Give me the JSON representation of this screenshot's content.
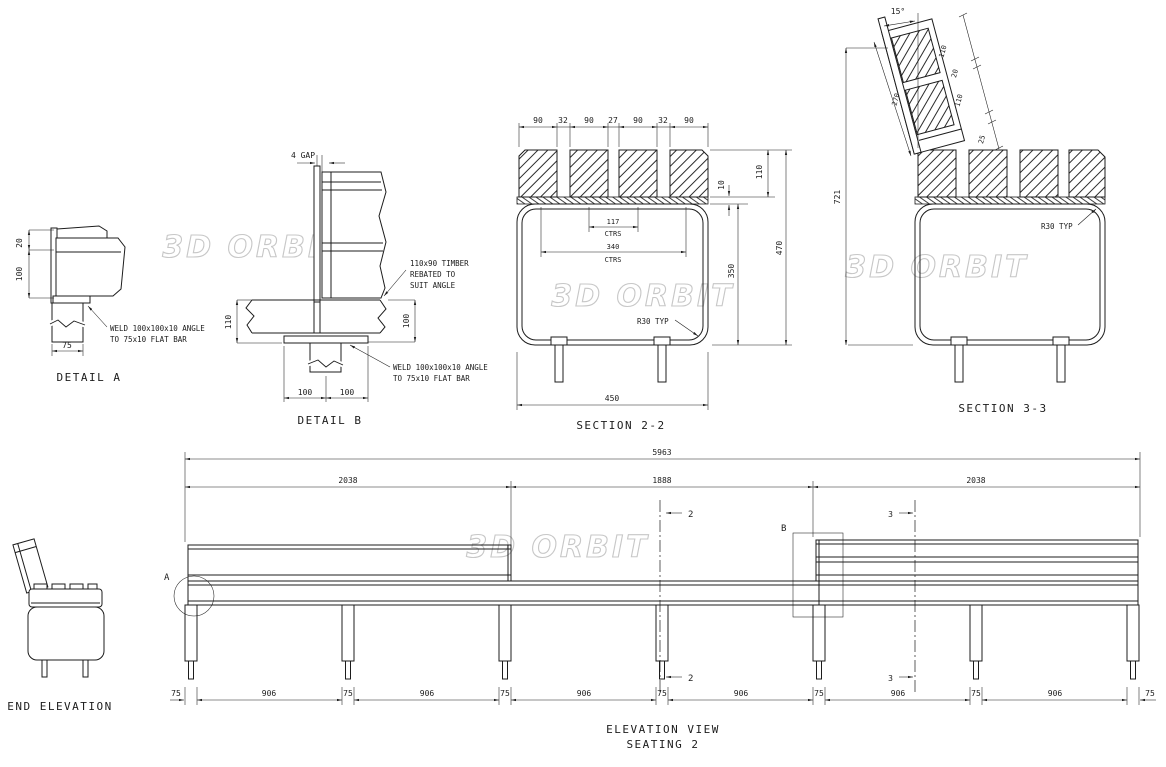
{
  "watermark": "3D ORBIT",
  "colors": {
    "line": "#1c1c1c",
    "watermark": "#c7c7c7",
    "background": "#ffffff"
  },
  "detail_a": {
    "title": "DETAIL A",
    "dim_20": "20",
    "dim_100": "100",
    "dim_75": "75",
    "note_weld_line1": "WELD 100x100x10 ANGLE",
    "note_weld_line2": "TO 75x10 FLAT BAR"
  },
  "detail_b": {
    "title": "DETAIL B",
    "dim_gap": "4 GAP",
    "note_timber_line1": "110x90 TIMBER",
    "note_timber_line2": "REBATED TO",
    "note_timber_line3": "SUIT ANGLE",
    "note_weld_line1": "WELD 100x100x10 ANGLE",
    "note_weld_line2": "TO 75x10 FLAT BAR",
    "dim_110": "110",
    "dim_100_right": "100",
    "dim_100_bottom_left": "100",
    "dim_100_bottom_right": "100"
  },
  "section_2_2": {
    "title": "SECTION 2-2",
    "top_dims": [
      "90",
      "32",
      "90",
      "27",
      "90",
      "32",
      "90"
    ],
    "dim_117": "117",
    "dim_340": "340",
    "ctrs_label": "CTRS",
    "dim_10": "10",
    "dim_110": "110",
    "dim_350": "350",
    "dim_470": "470",
    "dim_450": "450",
    "r30_note": "R30 TYP"
  },
  "section_3_3": {
    "title": "SECTION 3-3",
    "dim_angle": "15°",
    "dim_110_top": "110",
    "dim_20": "20",
    "dim_110_bottom": "110",
    "dim_25": "25",
    "dim_270": "270",
    "dim_721": "721",
    "r30_note": "R30 TYP"
  },
  "end_elevation": {
    "title": "END ELEVATION"
  },
  "elevation": {
    "title_line1": "ELEVATION VIEW",
    "title_line2": "SEATING 2",
    "dim_total": "5963",
    "dim_seg1": "2038",
    "dim_seg2": "1888",
    "dim_seg3": "2038",
    "bottom_dims": [
      "75",
      "906",
      "75",
      "906",
      "75",
      "906",
      "75",
      "906",
      "75",
      "906",
      "75",
      "906",
      "75"
    ],
    "section_marker_2": "2",
    "section_marker_3": "3",
    "detail_label_a": "A",
    "detail_label_b": "B"
  }
}
